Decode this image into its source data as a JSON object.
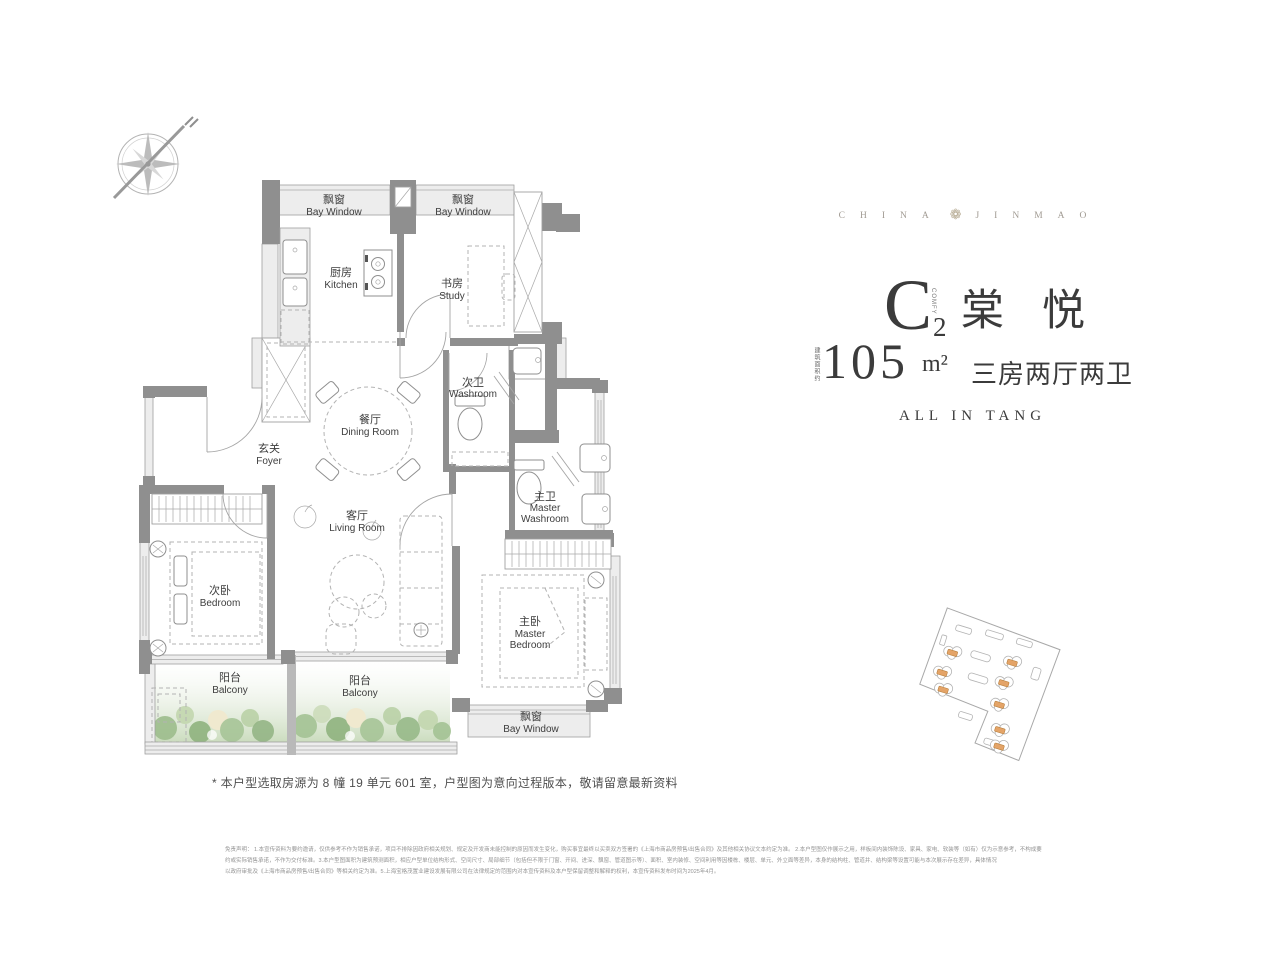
{
  "brand": {
    "left": "CHINA",
    "right": "JINMAO",
    "flower": "❁"
  },
  "unit": {
    "code_letter": "C",
    "code_sub": "2",
    "code_side": "COMFY",
    "name": "棠悦",
    "area_prefix": "建筑面积约",
    "area_value": "105",
    "area_unit": "m²",
    "layout": "三房两厅两卫",
    "slogan": "ALL IN TANG"
  },
  "floorplan": {
    "rooms": [
      {
        "id": "bay-window-kitchen",
        "zh": "飘窗",
        "en": "Bay Window"
      },
      {
        "id": "bay-window-study",
        "zh": "飘窗",
        "en": "Bay Window"
      },
      {
        "id": "kitchen",
        "zh": "厨房",
        "en": "Kitchen"
      },
      {
        "id": "study",
        "zh": "书房",
        "en": "Study"
      },
      {
        "id": "washroom",
        "zh": "次卫",
        "en": "Washroom"
      },
      {
        "id": "dining-room",
        "zh": "餐厅",
        "en": "Dining Room"
      },
      {
        "id": "foyer",
        "zh": "玄关",
        "en": "Foyer"
      },
      {
        "id": "master-washroom",
        "zh": "主卫",
        "en": "Master",
        "en2": "Washroom"
      },
      {
        "id": "living-room",
        "zh": "客厅",
        "en": "Living Room"
      },
      {
        "id": "bedroom",
        "zh": "次卧",
        "en": "Bedroom"
      },
      {
        "id": "master-bedroom",
        "zh": "主卧",
        "en": "Master",
        "en2": "Bedroom"
      },
      {
        "id": "balcony-1",
        "zh": "阳台",
        "en": "Balcony"
      },
      {
        "id": "balcony-2",
        "zh": "阳台",
        "en": "Balcony"
      },
      {
        "id": "bay-window-master",
        "zh": "飘窗",
        "en": "Bay Window"
      }
    ]
  },
  "note": "* 本户型选取房源为 8 幢 19 单元 601 室，户型图为意向过程版本，敬请留意最新资料",
  "disclaimer": {
    "lines": [
      "免责声明： 1.本宣传资料为要约邀请，仅供参考不作为销售承诺，项目不排除因政府相关规划、规定及开发商未能控制的原因而发生变化，购买事宜最终以买卖双方签署的《上海市商品房预售/出售合同》及其他相关协议文本约定为准。 2.本户型图仅作展示之用，样板间内装饰陈设、家具、家电、软装等（如有）仅为示意参考，不构成要",
      "约或实际销售承诺，不作为交付标准。3.本户型图面积为建筑预测面积，相应户型单位结构形式、空间尺寸、局部细节（包括但不限于门窗、开间、进深、飘窗、管道图示等）、面积、室内装修、空间利用等因楼栋、楼层、单元、外立面等差异，本身的结构柱、管道井、结构梁等设置可能与本次展示存在差异，具体情况",
      "以政府审批及《上海市商品房预售/出售合同》等相关约定为准。5.上海宝格茂置业建设发展有限公司在法律规定的范围内对本宣传资料及本户型保留调整和解释的权利，本宣传资料发布时间为2025年4月。"
    ]
  }
}
